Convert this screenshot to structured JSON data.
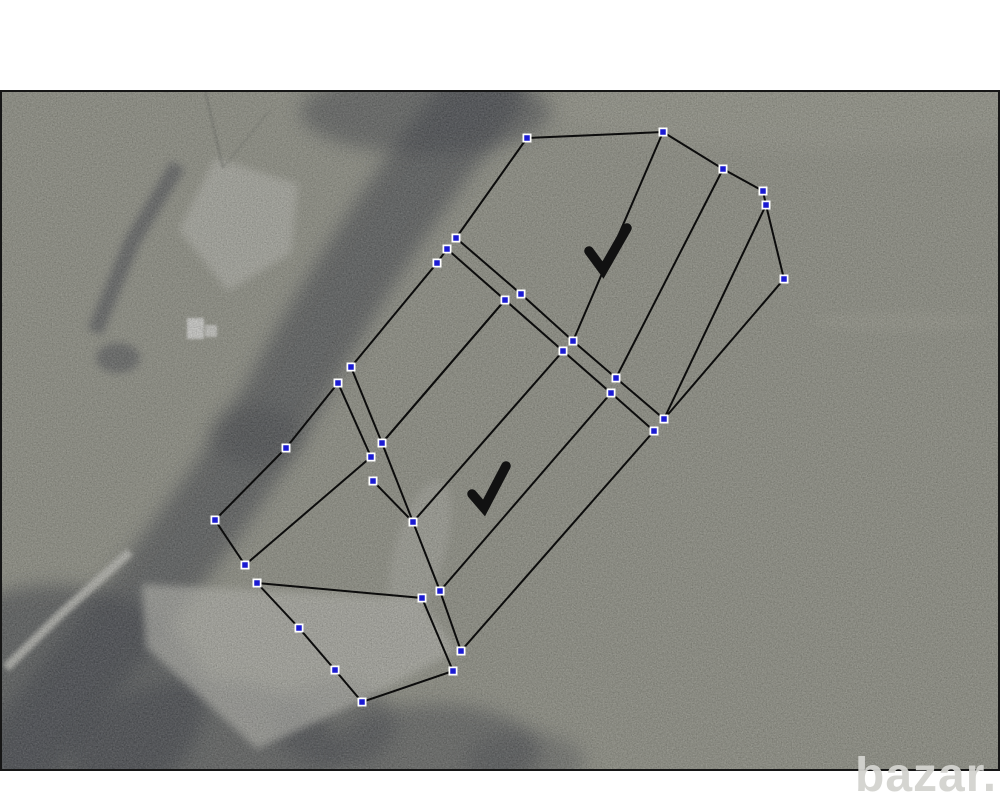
{
  "page": {
    "width": 1000,
    "height": 800,
    "background": "#ffffff"
  },
  "photo": {
    "x": 0,
    "y": 90,
    "width": 1000,
    "height": 681,
    "base_color": "#97988a",
    "border_color": "#161616"
  },
  "watermark": {
    "text": "bazar.ua",
    "color": "#d3d3cf"
  },
  "annotation": {
    "line_color": "#0c0c0c",
    "line_width": 2,
    "checkmark_color": "#111111",
    "checkmark_width": 9.5,
    "handle": {
      "fill": "#1a1ad2",
      "border": "#ffffff",
      "outer_size": 9,
      "core_size": 5.5
    },
    "parcels": [
      {
        "name": "parcel-upper",
        "points": [
          [
            527,
            138
          ],
          [
            663,
            132
          ],
          [
            723,
            169
          ],
          [
            763,
            191
          ],
          [
            766,
            205
          ],
          [
            784,
            279
          ],
          [
            664,
            419
          ],
          [
            616,
            378
          ],
          [
            573,
            341
          ],
          [
            521,
            294
          ],
          [
            456,
            238
          ]
        ]
      },
      {
        "name": "parcel-middle",
        "points": [
          [
            505,
            300
          ],
          [
            563,
            351
          ],
          [
            611,
            393
          ],
          [
            654,
            431
          ],
          [
            461,
            651
          ],
          [
            440,
            591
          ],
          [
            413,
            522
          ],
          [
            382,
            443
          ]
        ]
      },
      {
        "name": "parcel-lower",
        "points": [
          [
            257,
            583
          ],
          [
            299,
            628
          ],
          [
            335,
            670
          ],
          [
            362,
            702
          ],
          [
            453,
            671
          ],
          [
            422,
            598
          ]
        ]
      },
      {
        "name": "parcel-west-strip",
        "points": [
          [
            338,
            383
          ],
          [
            286,
            448
          ],
          [
            215,
            520
          ],
          [
            245,
            565
          ],
          [
            371,
            457
          ]
        ]
      },
      {
        "name": "parcel-east-strip",
        "points": [
          [
            447,
            249
          ],
          [
            437,
            263
          ],
          [
            351,
            367
          ],
          [
            382,
            443
          ],
          [
            505,
            300
          ]
        ]
      }
    ],
    "dividers": [
      {
        "from": [
          663,
          132
        ],
        "to": [
          573,
          341
        ]
      },
      {
        "from": [
          723,
          169
        ],
        "to": [
          616,
          378
        ]
      },
      {
        "from": [
          766,
          205
        ],
        "to": [
          664,
          419
        ]
      },
      {
        "from": [
          563,
          351
        ],
        "to": [
          413,
          522
        ]
      },
      {
        "from": [
          611,
          393
        ],
        "to": [
          440,
          591
        ]
      }
    ],
    "extra_segments": [
      {
        "from": [
          373,
          481
        ],
        "to": [
          413,
          522
        ]
      }
    ],
    "checkmarks": [
      {
        "points": [
          [
            589,
            251
          ],
          [
            603,
            270
          ],
          [
            627,
            228
          ]
        ]
      },
      {
        "points": [
          [
            472,
            494
          ],
          [
            484,
            508
          ],
          [
            506,
            466
          ]
        ]
      }
    ]
  }
}
